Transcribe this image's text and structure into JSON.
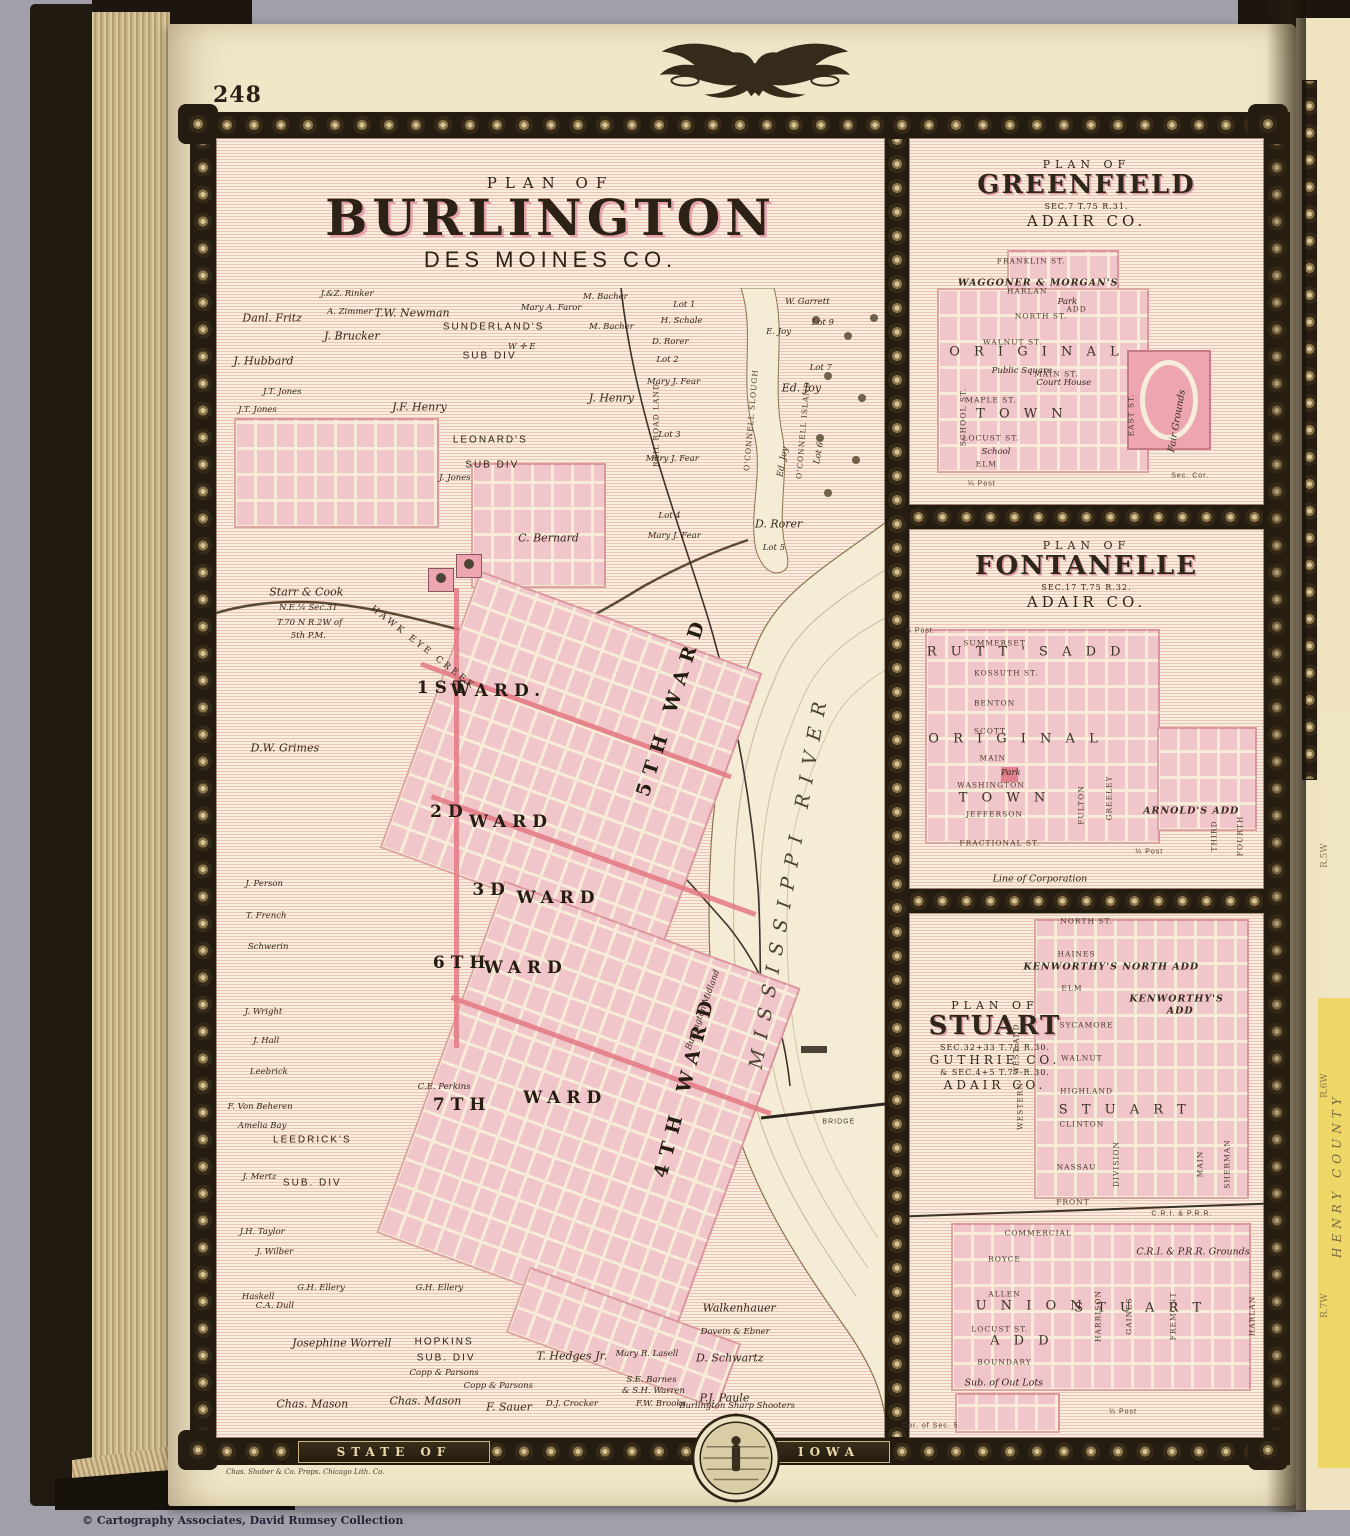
{
  "page": {
    "number": "248",
    "printer_credit": "Chas. Shober & Co. Props. Chicago Lith. Co.",
    "copyright": "© Cartography Associates, David Rumsey Collection",
    "banner_left": "STATE OF",
    "banner_right": "IOWA",
    "colors": {
      "page": "#f0e6c8",
      "pink_block": "#f1c6ca",
      "hatch_red": "#d56464",
      "border": "#241c10",
      "accent_pink": "#e47884"
    }
  },
  "next_page": {
    "county": "HENRY COUNTY",
    "ranges": [
      "R.5W",
      "R.6W",
      "R.7W"
    ]
  },
  "burlington": {
    "plan_of": "PLAN OF",
    "name": "BURLINGTON",
    "county": "DES MOINES CO.",
    "labels": [
      {
        "t": "Danl. Fritz",
        "x": 8.4,
        "y": 2.7,
        "c": "n"
      },
      {
        "t": "J.&Z. Rinker",
        "x": 19.6,
        "y": 0.5,
        "c": "t"
      },
      {
        "t": "A. Zimmer",
        "x": 20,
        "y": 2.1,
        "c": "t"
      },
      {
        "t": "J. Brucker",
        "x": 20.3,
        "y": 4.3,
        "c": "n"
      },
      {
        "t": "T.W. Newman",
        "x": 29.3,
        "y": 2.2,
        "c": "n"
      },
      {
        "t": "SUNDERLAND'S",
        "x": 41.5,
        "y": 3.5,
        "c": "s"
      },
      {
        "t": "SUB DIV",
        "x": 40.9,
        "y": 6,
        "c": "s"
      },
      {
        "t": "Mary A. Faror",
        "x": 50.1,
        "y": 1.8,
        "c": "t"
      },
      {
        "t": "M. Bacher",
        "x": 58.2,
        "y": 0.8,
        "c": "t"
      },
      {
        "t": "M. Bacher",
        "x": 59.1,
        "y": 3.5,
        "c": "t"
      },
      {
        "t": "J. Hubbard",
        "x": 7.1,
        "y": 6.5,
        "c": "n"
      },
      {
        "t": "J.T. Jones",
        "x": 9.9,
        "y": 9.2,
        "c": "t"
      },
      {
        "t": "J.T. Jones",
        "x": 6.2,
        "y": 10.8,
        "c": "t"
      },
      {
        "t": "J.F. Henry",
        "x": 30.4,
        "y": 10.6,
        "c": "n"
      },
      {
        "t": "J. Henry",
        "x": 59.1,
        "y": 9.8,
        "c": "n"
      },
      {
        "t": "W. Garrett",
        "x": 88.4,
        "y": 1.2,
        "c": "t"
      },
      {
        "t": "Lot 9",
        "x": 90.7,
        "y": 3.1,
        "c": "t"
      },
      {
        "t": "E. Joy",
        "x": 84.1,
        "y": 3.9,
        "c": "t"
      },
      {
        "t": "Lot 1",
        "x": 70,
        "y": 1.5,
        "c": "t"
      },
      {
        "t": "H. Schale",
        "x": 69.6,
        "y": 2.9,
        "c": "t"
      },
      {
        "t": "D. Rorer",
        "x": 67.9,
        "y": 4.8,
        "c": "t"
      },
      {
        "t": "Lot 2",
        "x": 67.5,
        "y": 6.4,
        "c": "t"
      },
      {
        "t": "Mary J. Fear",
        "x": 68.4,
        "y": 8.3,
        "c": "t"
      },
      {
        "t": "Lot 7",
        "x": 90.4,
        "y": 7.1,
        "c": "t"
      },
      {
        "t": "Ed. Joy",
        "x": 87.5,
        "y": 8.9,
        "c": "n"
      },
      {
        "t": "Lot 3",
        "x": 67.8,
        "y": 13,
        "c": "t"
      },
      {
        "t": "Mary J. Fear",
        "x": 68.2,
        "y": 15.2,
        "c": "t"
      },
      {
        "t": "Ed. Joy",
        "x": 84.7,
        "y": 15.4,
        "c": "t",
        "r": -80
      },
      {
        "t": "Lot 6",
        "x": 90.1,
        "y": 14.6,
        "c": "t",
        "r": -80
      },
      {
        "t": "Lot 4",
        "x": 67.8,
        "y": 20.2,
        "c": "t"
      },
      {
        "t": "Mary J. Fear",
        "x": 68.5,
        "y": 22,
        "c": "t"
      },
      {
        "t": "D. Rorer",
        "x": 84.1,
        "y": 20.9,
        "c": "n"
      },
      {
        "t": "Lot 5",
        "x": 83.4,
        "y": 23.1,
        "c": "t"
      },
      {
        "t": "O'CONNELL SLOUGH",
        "x": 79.9,
        "y": 11.7,
        "c": "vst",
        "r": -85
      },
      {
        "t": "O'CONNELL ISLAND",
        "x": 87.8,
        "y": 12.6,
        "c": "vst",
        "r": -85
      },
      {
        "t": "RAIL ROAD LAND",
        "x": 65.7,
        "y": 12.2,
        "c": "vst",
        "r": -90
      },
      {
        "t": "LEONARD'S",
        "x": 41,
        "y": 13.5,
        "c": "s"
      },
      {
        "t": "SUB DIV",
        "x": 41.3,
        "y": 15.7,
        "c": "s"
      },
      {
        "t": "J. Jones",
        "x": 35.7,
        "y": 16.9,
        "c": "t"
      },
      {
        "t": "C. Bernard",
        "x": 49.7,
        "y": 22.2,
        "c": "n"
      },
      {
        "t": "W ✛ E",
        "x": 45.7,
        "y": 5.2,
        "c": "t"
      },
      {
        "t": "Starr & Cook",
        "x": 13.5,
        "y": 27,
        "c": "n"
      },
      {
        "t": "N.E.¼ Sec.31",
        "x": 13.8,
        "y": 28.4,
        "c": "t"
      },
      {
        "t": "T.70 N R.2W of",
        "x": 14,
        "y": 29.7,
        "c": "t"
      },
      {
        "t": "5th P.M.",
        "x": 13.8,
        "y": 30.9,
        "c": "t"
      },
      {
        "t": "HAWK EYE CREEK",
        "x": 30.9,
        "y": 31.9,
        "c": "crk",
        "r": 38
      },
      {
        "t": "D.W. Grimes",
        "x": 10.3,
        "y": 40.8,
        "c": "n"
      },
      {
        "t": "1ST",
        "x": 34.1,
        "y": 35.5,
        "c": "w"
      },
      {
        "t": "WARD.",
        "x": 42.2,
        "y": 35.8,
        "c": "w"
      },
      {
        "t": "5TH WARD",
        "x": 68.1,
        "y": 37,
        "c": "bw",
        "r": -72
      },
      {
        "t": "2D",
        "x": 34.9,
        "y": 46.5,
        "c": "w"
      },
      {
        "t": "WARD",
        "x": 44.1,
        "y": 47.4,
        "c": "w"
      },
      {
        "t": "3D",
        "x": 41.2,
        "y": 53.4,
        "c": "w"
      },
      {
        "t": "WARD",
        "x": 51.2,
        "y": 54.1,
        "c": "w"
      },
      {
        "t": "6TH",
        "x": 36.8,
        "y": 59.9,
        "c": "w"
      },
      {
        "t": "WARD",
        "x": 46.3,
        "y": 60.3,
        "c": "w"
      },
      {
        "t": "7TH",
        "x": 36.8,
        "y": 72.5,
        "c": "w"
      },
      {
        "t": "WARD",
        "x": 52.2,
        "y": 71.9,
        "c": "w"
      },
      {
        "t": "4TH WARD",
        "x": 70.1,
        "y": 70.7,
        "c": "bw",
        "r": -75
      },
      {
        "t": "MISSISSIPPI RIVER",
        "x": 85.7,
        "y": 52.5,
        "c": "riv",
        "r": -80
      },
      {
        "t": "Burlington Midland",
        "x": 72.8,
        "y": 64.1,
        "c": "t",
        "r": -70
      },
      {
        "t": "J. Person",
        "x": 7.2,
        "y": 52.9,
        "c": "t"
      },
      {
        "t": "T. French",
        "x": 7.5,
        "y": 55.7,
        "c": "t"
      },
      {
        "t": "Schwerin",
        "x": 7.8,
        "y": 58.5,
        "c": "t"
      },
      {
        "t": "J. Wright",
        "x": 7.1,
        "y": 64.2,
        "c": "t"
      },
      {
        "t": "J. Hall",
        "x": 7.5,
        "y": 66.8,
        "c": "t"
      },
      {
        "t": "Leebrick",
        "x": 7.9,
        "y": 69.6,
        "c": "t"
      },
      {
        "t": "F. Von Beheren",
        "x": 6.6,
        "y": 72.7,
        "c": "t"
      },
      {
        "t": "Amelia Bay",
        "x": 6.9,
        "y": 74.4,
        "c": "t"
      },
      {
        "t": "J. Mertz",
        "x": 6.5,
        "y": 78.9,
        "c": "t"
      },
      {
        "t": "LEEDRICK'S",
        "x": 14.4,
        "y": 75.6,
        "c": "s"
      },
      {
        "t": "SUB. DIV",
        "x": 14.4,
        "y": 79.4,
        "c": "s"
      },
      {
        "t": "J.H. Taylor",
        "x": 6.9,
        "y": 83.8,
        "c": "t"
      },
      {
        "t": "J. Wilber",
        "x": 8.8,
        "y": 85.5,
        "c": "t"
      },
      {
        "t": "G.H. Ellery",
        "x": 15.7,
        "y": 88.7,
        "c": "t"
      },
      {
        "t": "Haskell",
        "x": 6.3,
        "y": 89.5,
        "c": "t"
      },
      {
        "t": "C.A. Dull",
        "x": 8.8,
        "y": 90.3,
        "c": "t"
      },
      {
        "t": "G.H. Ellery",
        "x": 33.4,
        "y": 88.7,
        "c": "t"
      },
      {
        "t": "Josephine Worrell",
        "x": 18.8,
        "y": 93.6,
        "c": "n"
      },
      {
        "t": "HOPKINS",
        "x": 34.1,
        "y": 93.5,
        "c": "s"
      },
      {
        "t": "SUB. DIV",
        "x": 34.4,
        "y": 94.9,
        "c": "s"
      },
      {
        "t": "Copp & Parsons",
        "x": 34.1,
        "y": 96.3,
        "c": "t"
      },
      {
        "t": "Copp & Parsons",
        "x": 42.2,
        "y": 97.4,
        "c": "t"
      },
      {
        "t": "Chas. Mason",
        "x": 14.4,
        "y": 99,
        "c": "n"
      },
      {
        "t": "Chas. Mason",
        "x": 31.3,
        "y": 98.8,
        "c": "n"
      },
      {
        "t": "T. Hedges Jr.",
        "x": 53.2,
        "y": 94.8,
        "c": "n"
      },
      {
        "t": "Mary R. Lasell",
        "x": 64.4,
        "y": 94.6,
        "c": "t"
      },
      {
        "t": "S.E. Barnes",
        "x": 65.1,
        "y": 96.9,
        "c": "t"
      },
      {
        "t": "& S.H. Warren",
        "x": 65.4,
        "y": 97.9,
        "c": "t"
      },
      {
        "t": "F. Sauer",
        "x": 43.8,
        "y": 99.3,
        "c": "n"
      },
      {
        "t": "D.J. Crocker",
        "x": 53.2,
        "y": 99,
        "c": "t"
      },
      {
        "t": "F.W. Brooks",
        "x": 66.5,
        "y": 99,
        "c": "t"
      },
      {
        "t": "Burlington Sharp Shooters",
        "x": 77.9,
        "y": 99.2,
        "c": "t"
      },
      {
        "t": "P.J. Paule",
        "x": 76,
        "y": 98.5,
        "c": "n"
      },
      {
        "t": "D. Schwartz",
        "x": 76.8,
        "y": 94.9,
        "c": "n"
      },
      {
        "t": "Walkenhauer",
        "x": 78.2,
        "y": 90.5,
        "c": "n"
      },
      {
        "t": "Dovein & Ebner",
        "x": 77.6,
        "y": 92.6,
        "c": "t"
      },
      {
        "t": "C.E. Perkins",
        "x": 34.1,
        "y": 70.9,
        "c": "t"
      },
      {
        "t": "BRIDGE",
        "x": 93.1,
        "y": 74,
        "c": "t2"
      }
    ]
  },
  "greenfield": {
    "plan_of": "PLAN OF",
    "name": "GREENFIELD",
    "sec": "SEC.7 T.75 R.31.",
    "county": "ADAIR CO.",
    "labels": [
      {
        "t": "FRANKLIN ST.",
        "x": 34.4,
        "y": 33.5,
        "c": "st"
      },
      {
        "t": "WAGGONER & MORGAN'S",
        "x": 36.4,
        "y": 39.4,
        "c": "big2"
      },
      {
        "t": "HARLAN",
        "x": 33.3,
        "y": 41.6,
        "c": "st"
      },
      {
        "t": "Park",
        "x": 44.6,
        "y": 44.7,
        "c": "t"
      },
      {
        "t": "ADD",
        "x": 47.2,
        "y": 46.6,
        "c": "st"
      },
      {
        "t": "NORTH ST.",
        "x": 37.2,
        "y": 48.6,
        "c": "st"
      },
      {
        "t": "WALNUT ST.",
        "x": 29.2,
        "y": 55.6,
        "c": "st"
      },
      {
        "t": "O R I G I N A L",
        "x": 35.9,
        "y": 58.4,
        "c": "big"
      },
      {
        "t": "Public Square",
        "x": 31.8,
        "y": 63.4,
        "c": "t"
      },
      {
        "t": "MAIN ST.",
        "x": 41.5,
        "y": 64.2,
        "c": "st"
      },
      {
        "t": "Court House",
        "x": 43.6,
        "y": 66.8,
        "c": "t"
      },
      {
        "t": "MAPLE ST.",
        "x": 23.1,
        "y": 71.5,
        "c": "st"
      },
      {
        "t": "T O W N",
        "x": 31.8,
        "y": 75.1,
        "c": "big"
      },
      {
        "t": "LOCUST ST.",
        "x": 23.1,
        "y": 81.8,
        "c": "st"
      },
      {
        "t": "School",
        "x": 24.5,
        "y": 85.5,
        "c": "t"
      },
      {
        "t": "ELM",
        "x": 21.8,
        "y": 88.8,
        "c": "st"
      },
      {
        "t": "SCHOOL ST.",
        "x": 15.1,
        "y": 76,
        "c": "vst",
        "r": -90
      },
      {
        "t": "EAST ST.",
        "x": 62.6,
        "y": 75.4,
        "c": "vst",
        "r": -90
      },
      {
        "t": "Fair Grounds",
        "x": 75.4,
        "y": 77.1,
        "c": "it",
        "r": -80
      },
      {
        "t": "Sec. Cor.",
        "x": 79.2,
        "y": 92.2,
        "c": "t2"
      },
      {
        "t": "¼ Post",
        "x": 20.5,
        "y": 94.4,
        "c": "t2"
      }
    ]
  },
  "fontanelle": {
    "plan_of": "PLAN OF",
    "name": "FONTANELLE",
    "sec": "SEC.17 T.75 R.32.",
    "county": "ADAIR CO.",
    "labels": [
      {
        "t": "SUMMERSET",
        "x": 24.1,
        "y": 31.7,
        "c": "st"
      },
      {
        "t": "R U T T ' S   A D D",
        "x": 33,
        "y": 34.3,
        "c": "big"
      },
      {
        "t": "KOSSUTH ST.",
        "x": 27.4,
        "y": 40,
        "c": "st"
      },
      {
        "t": "BENTON",
        "x": 24.1,
        "y": 48.3,
        "c": "st"
      },
      {
        "t": "SCOTT",
        "x": 22.8,
        "y": 56,
        "c": "st"
      },
      {
        "t": "O R I G I N A L",
        "x": 30,
        "y": 58.4,
        "c": "big"
      },
      {
        "t": "MAIN",
        "x": 23.6,
        "y": 63.7,
        "c": "st"
      },
      {
        "t": "Park",
        "x": 28.7,
        "y": 67.7,
        "c": "t"
      },
      {
        "t": "WASHINGTON",
        "x": 23.1,
        "y": 71.2,
        "c": "st"
      },
      {
        "t": "T O W N",
        "x": 26.9,
        "y": 74.7,
        "c": "big"
      },
      {
        "t": "JEFFERSON",
        "x": 24.1,
        "y": 79.2,
        "c": "st"
      },
      {
        "t": "FRACTIONAL ST.",
        "x": 25.6,
        "y": 87.2,
        "c": "st"
      },
      {
        "t": "ARNOLD'S ADD",
        "x": 79.5,
        "y": 78.4,
        "c": "big2"
      },
      {
        "t": "Line of Corporation",
        "x": 36.9,
        "y": 97.3,
        "c": "it"
      },
      {
        "t": "GREELEY",
        "x": 56.2,
        "y": 74.7,
        "c": "vst",
        "r": -90
      },
      {
        "t": "FULTON",
        "x": 48.5,
        "y": 76.8,
        "c": "vst",
        "r": -90
      },
      {
        "t": "THIRD",
        "x": 85.9,
        "y": 85.3,
        "c": "vst",
        "r": -90
      },
      {
        "t": "FOURTH",
        "x": 93.3,
        "y": 85.3,
        "c": "vst",
        "r": -90
      },
      {
        "t": "¼ Post",
        "x": 2.8,
        "y": 28.3,
        "c": "t2"
      },
      {
        "t": "¼ Post",
        "x": 67.7,
        "y": 89.6,
        "c": "t2"
      }
    ]
  },
  "stuart": {
    "plan_of": "PLAN OF",
    "name": "STUART",
    "sec1": "SEC.32+33 T.78 R.30.",
    "county1": "GUTHRIE CO.",
    "sec2": "& SEC.4+5 T.77-R.30.",
    "county2": "ADAIR CO.",
    "labels": [
      {
        "t": "NORTH ST.",
        "x": 50,
        "y": 1.6,
        "c": "st"
      },
      {
        "t": "HAINES",
        "x": 47.2,
        "y": 7.9,
        "c": "st"
      },
      {
        "t": "KENWORTHY'S NORTH ADD",
        "x": 57,
        "y": 10.2,
        "c": "big2"
      },
      {
        "t": "ELM",
        "x": 45.9,
        "y": 14.2,
        "c": "st"
      },
      {
        "t": "KENWORTHY'S",
        "x": 75.4,
        "y": 16.3,
        "c": "big2"
      },
      {
        "t": "ADD",
        "x": 76.4,
        "y": 18.7,
        "c": "big2"
      },
      {
        "t": "SYCAMORE",
        "x": 50,
        "y": 21.4,
        "c": "st"
      },
      {
        "t": "WALNUT",
        "x": 48.7,
        "y": 27.6,
        "c": "st"
      },
      {
        "t": "HIGHLAND",
        "x": 50,
        "y": 33.9,
        "c": "st"
      },
      {
        "t": "S T U A R T",
        "x": 60.8,
        "y": 37.5,
        "c": "big"
      },
      {
        "t": "CLINTON",
        "x": 48.7,
        "y": 40.2,
        "c": "st"
      },
      {
        "t": "NASSAU",
        "x": 47.2,
        "y": 48.3,
        "c": "st"
      },
      {
        "t": "FRONT",
        "x": 46.2,
        "y": 55.1,
        "c": "st"
      },
      {
        "t": "C.R.I. & P.R.R.",
        "x": 76.9,
        "y": 57.3,
        "c": "t2"
      },
      {
        "t": "COMMERCIAL",
        "x": 36.4,
        "y": 61,
        "c": "st"
      },
      {
        "t": "C.R.I. & P.R.R. Grounds",
        "x": 80,
        "y": 64.5,
        "c": "it"
      },
      {
        "t": "ROYCE",
        "x": 26.9,
        "y": 65.9,
        "c": "st"
      },
      {
        "t": "ALLEN",
        "x": 26.9,
        "y": 72.5,
        "c": "st"
      },
      {
        "t": "U N I O N",
        "x": 34.4,
        "y": 74.9,
        "c": "big"
      },
      {
        "t": "S T U A R T",
        "x": 65.1,
        "y": 75.2,
        "c": "big"
      },
      {
        "t": "LOCUST ST.",
        "x": 25.6,
        "y": 79.2,
        "c": "st"
      },
      {
        "t": "A D D",
        "x": 31.8,
        "y": 81.5,
        "c": "big"
      },
      {
        "t": "BOUNDARY",
        "x": 26.9,
        "y": 85.6,
        "c": "st"
      },
      {
        "t": "Sub. of Out Lots",
        "x": 26.7,
        "y": 89.6,
        "c": "it"
      },
      {
        "t": "¼ Post",
        "x": 60.3,
        "y": 95,
        "c": "t2"
      },
      {
        "t": "Cor. of Sec. 5",
        "x": 6,
        "y": 97.7,
        "c": "t2"
      },
      {
        "t": "WEST ADD",
        "x": 30,
        "y": 25.9,
        "c": "vst",
        "r": -90
      },
      {
        "t": "WESTERN",
        "x": 31.3,
        "y": 36.8,
        "c": "vst",
        "r": -90
      },
      {
        "t": "DIVISION",
        "x": 58.2,
        "y": 47.9,
        "c": "vst",
        "r": -90
      },
      {
        "t": "MAIN",
        "x": 82.1,
        "y": 47.9,
        "c": "vst",
        "r": -90
      },
      {
        "t": "SHERMAN",
        "x": 89.7,
        "y": 47.9,
        "c": "vst",
        "r": -90
      },
      {
        "t": "HARRISON",
        "x": 53.1,
        "y": 76.7,
        "c": "vst",
        "r": -90
      },
      {
        "t": "GAINES",
        "x": 62.1,
        "y": 76.7,
        "c": "vst",
        "r": -90
      },
      {
        "t": "FREMONT",
        "x": 74.5,
        "y": 76.7,
        "c": "vst",
        "r": -90
      },
      {
        "t": "HARLAN",
        "x": 96.5,
        "y": 76.7,
        "c": "vst",
        "r": -90
      }
    ]
  }
}
